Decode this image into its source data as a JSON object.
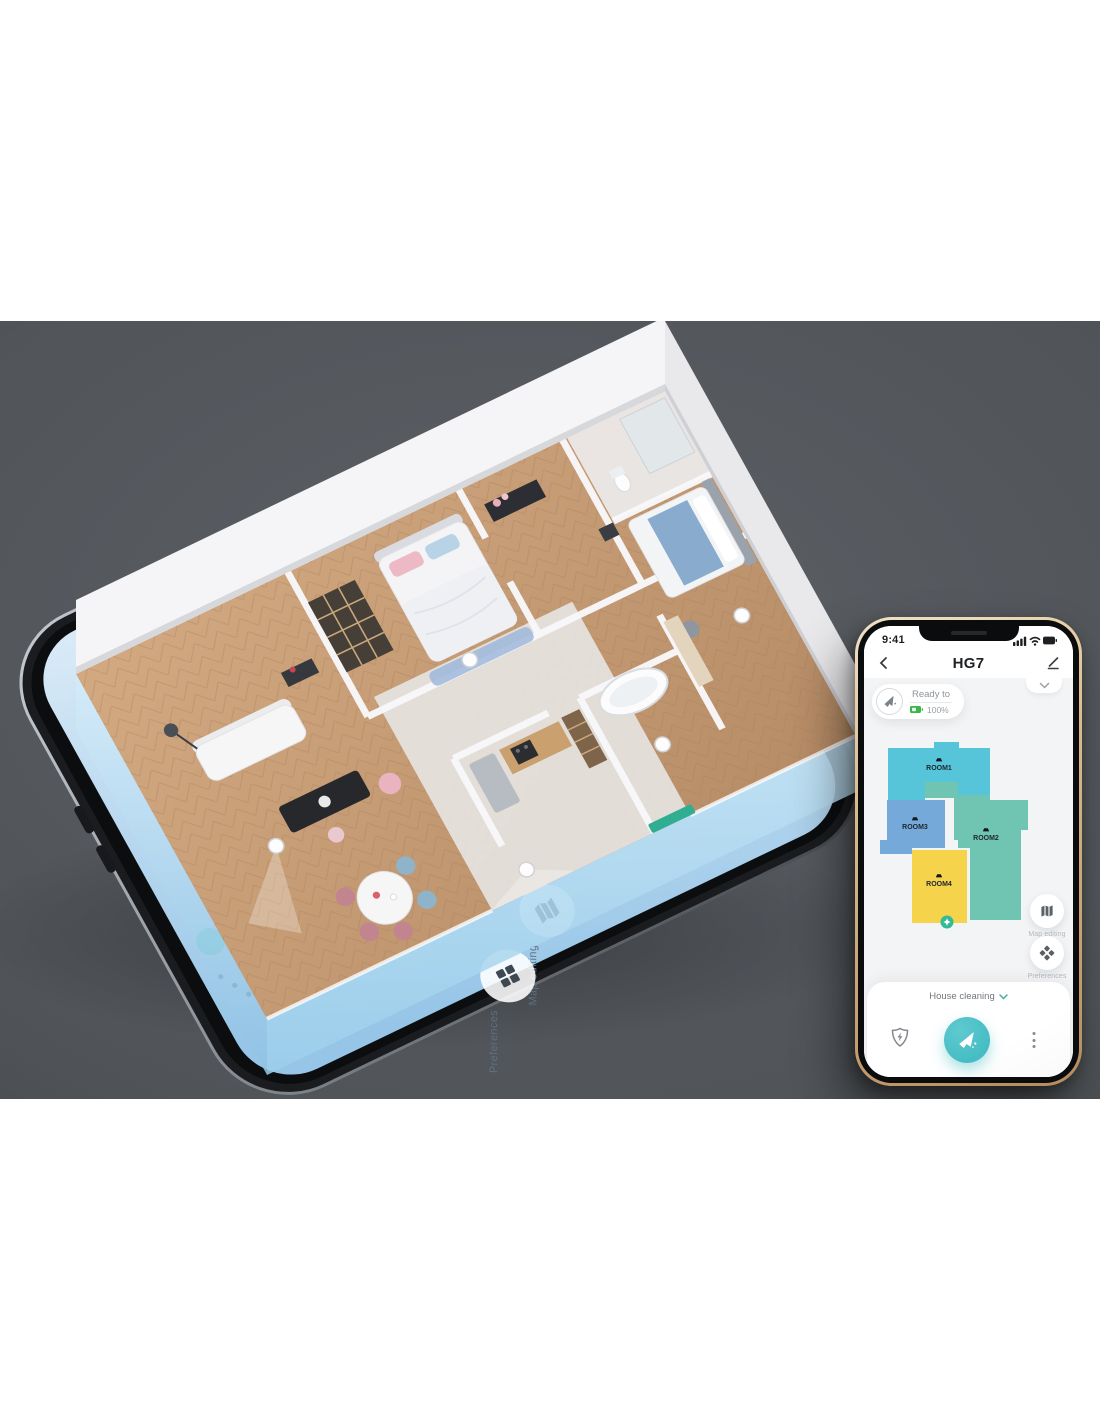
{
  "photo": {
    "background": "#54585d"
  },
  "scene": {
    "big_phone": {
      "buttons": [
        {
          "label": "Map editing",
          "icon": "map-icon"
        },
        {
          "label": "Preferences",
          "icon": "grid-icon"
        }
      ]
    }
  },
  "app": {
    "status_bar": {
      "time": "9:41",
      "icons": [
        "signal-icon",
        "wifi-icon",
        "battery-icon"
      ]
    },
    "header": {
      "back_icon": "chevron-left-icon",
      "title": "HG7",
      "edit_icon": "pencil-icon"
    },
    "panel_toggle_icon": "chevron-down-icon",
    "status_chip": {
      "robot_icon": "robot-vacuum-icon",
      "status": "Ready to",
      "battery_icon": "battery-icon",
      "battery_level": "100%",
      "battery_color": "#3cb54b"
    },
    "map": {
      "rooms": [
        {
          "label": "ROOM1",
          "color": "#57c5d9"
        },
        {
          "label": "ROOM2",
          "color": "#6fc5b2"
        },
        {
          "label": "ROOM3",
          "color": "#74a9da"
        },
        {
          "label": "ROOM4",
          "color": "#f5d34b"
        }
      ],
      "robot_marker": {
        "icon": "sparkle-icon",
        "color": "#35ba95"
      }
    },
    "quick_actions": [
      {
        "label": "Map editing",
        "icon": "map-icon"
      },
      {
        "label": "Preferences",
        "icon": "diamond-grid-icon"
      }
    ],
    "bottom_panel": {
      "mode_label": "House cleaning",
      "mode_caret_icon": "chevron-down-icon",
      "recharge_icon": "shield-bolt-icon",
      "clean_button_icon": "robot-clean-icon",
      "clean_button_color": "#46bdc4",
      "more_icon": "kebab-menu-icon"
    }
  }
}
